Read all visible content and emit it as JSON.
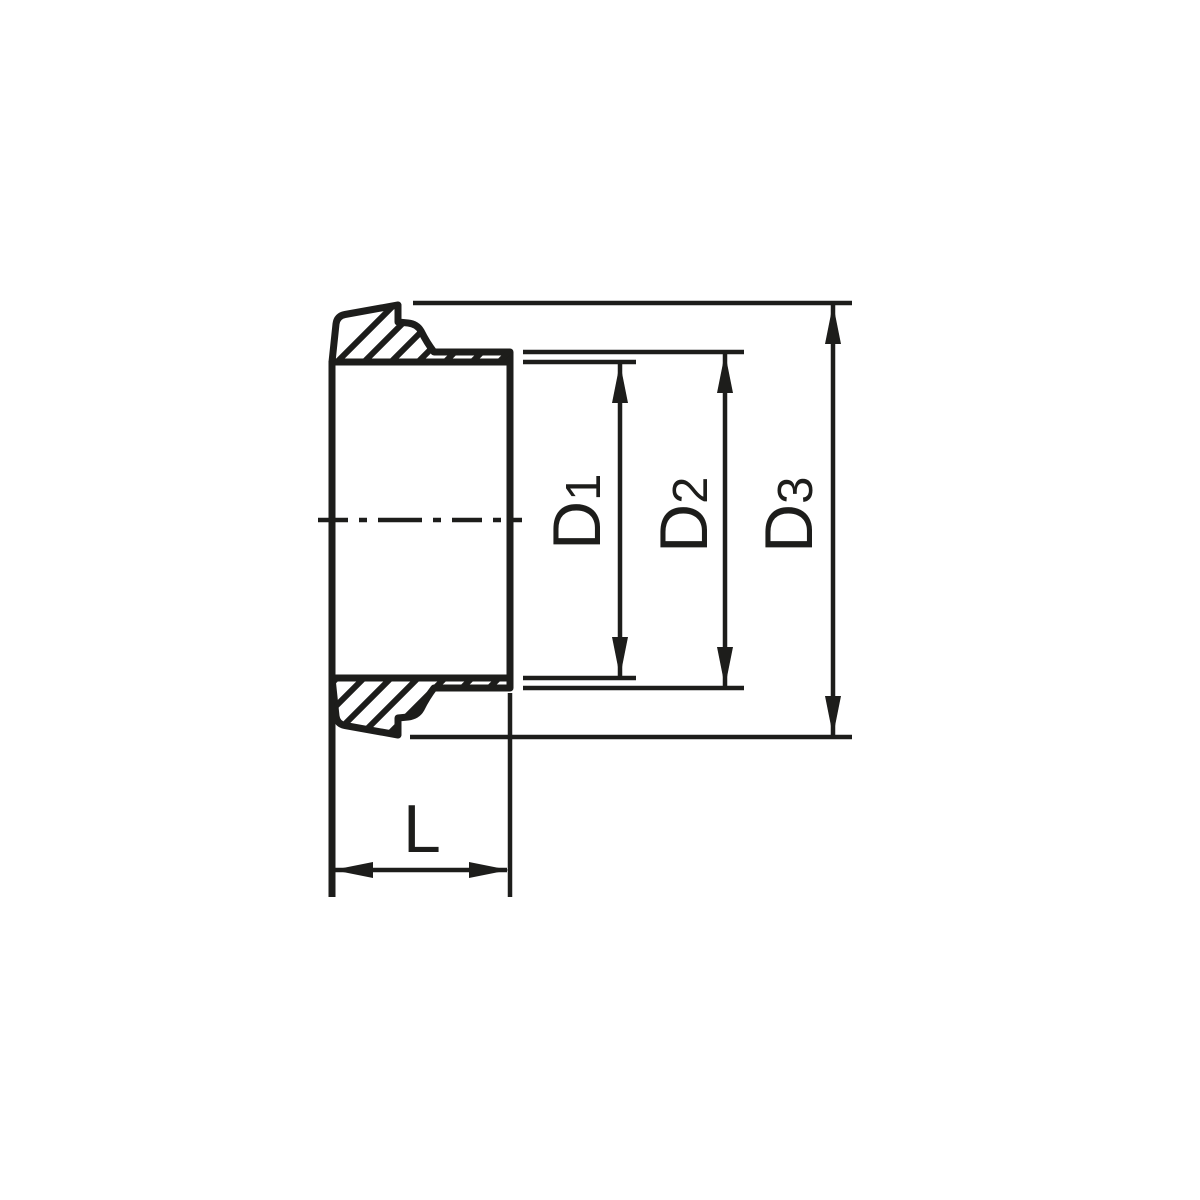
{
  "drawing": {
    "kind": "technical-cross-section",
    "view": "side section of pipe union liner with hatched wall sections"
  },
  "dimensions": {
    "d1": {
      "letter": "D",
      "index": "1"
    },
    "d2": {
      "letter": "D",
      "index": "2"
    },
    "d3": {
      "letter": "D",
      "index": "3"
    },
    "length": {
      "label": "L"
    }
  },
  "colors": {
    "line": "#1d1d1b",
    "background": "#ffffff"
  }
}
